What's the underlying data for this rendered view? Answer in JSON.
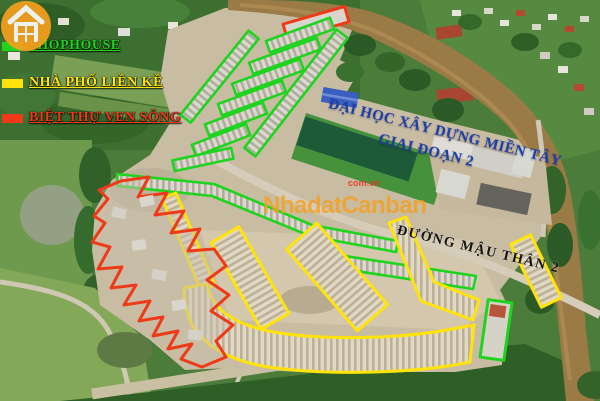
{
  "meta": {
    "title": "Aerial real-estate site plan with zoning annotations"
  },
  "colors": {
    "shophouse": "#1ed41e",
    "townhouse": "#ffe30a",
    "villa": "#ee3a18",
    "university-text": "#1d3fae",
    "road-text": "#141414",
    "watermark-orange": "#f6a01e",
    "watermark-red": "#e8361c"
  },
  "legend": {
    "items": [
      {
        "key": "shophouse",
        "label": "SHOPHOUSE"
      },
      {
        "key": "townhouse",
        "label": "NHÀ PHỐ LIỀN KỀ"
      },
      {
        "key": "villa",
        "label": "BIỆT THỰ VEN SÔNG"
      }
    ]
  },
  "labels": {
    "university_line1": "ĐẠI HỌC XÂY DỰNG MIỀN TÂY",
    "university_line2": "GIAI ĐOẠN 2",
    "road": "ĐƯỜNG MẬU THÂN 2"
  },
  "watermark": {
    "name": "NhadatCanban",
    "domain": "com.vn",
    "icon": "house-icon"
  }
}
